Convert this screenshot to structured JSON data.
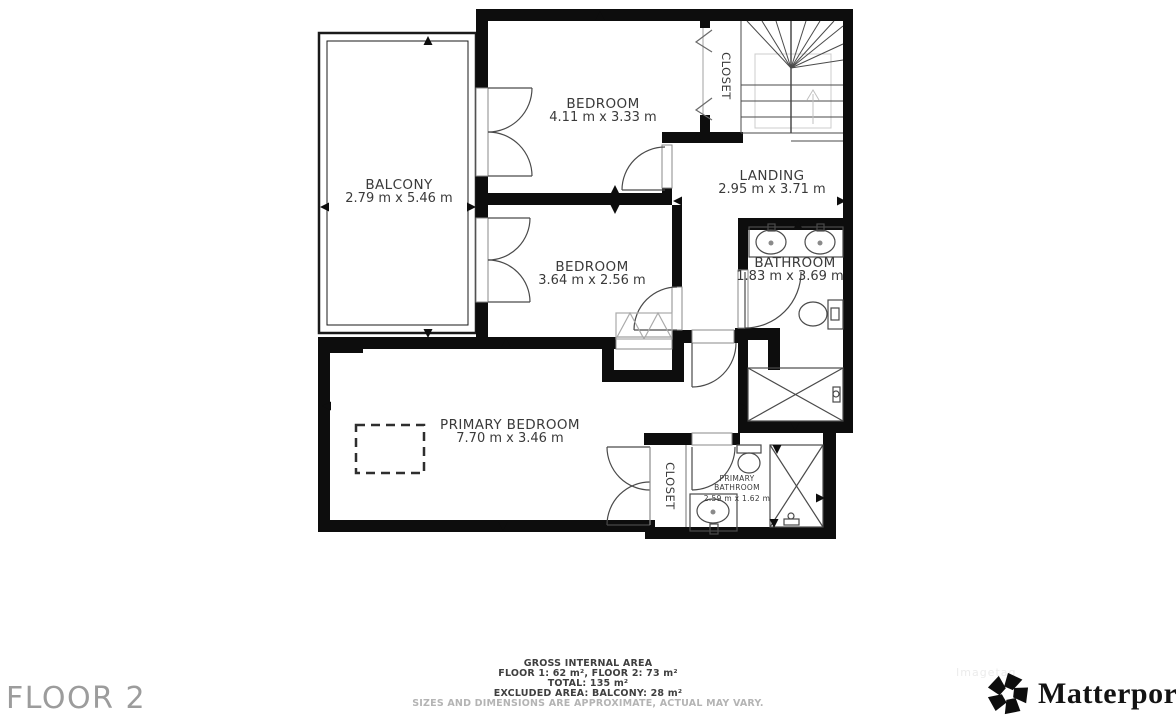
{
  "plan": {
    "rooms": {
      "balcony": {
        "name": "BALCONY",
        "dims": "2.79 m x 5.46 m"
      },
      "bedroom1": {
        "name": "BEDROOM",
        "dims": "4.11 m x 3.33 m"
      },
      "bedroom2": {
        "name": "BEDROOM",
        "dims": "3.64 m x 2.56 m"
      },
      "landing": {
        "name": "LANDING",
        "dims": "2.95 m x 3.71 m"
      },
      "bathroom": {
        "name": "BATHROOM",
        "dims": "1.83 m x 3.69 m"
      },
      "primary_bedroom": {
        "name": "PRIMARY BEDROOM",
        "dims": "7.70 m x 3.46 m"
      },
      "primary_bathroom": {
        "name_line1": "PRIMARY",
        "name_line2": "BATHROOM",
        "dims": "2.59 m x 1.62 m"
      },
      "closet_upper": {
        "name": "CLOSET"
      },
      "closet_primary": {
        "name": "CLOSET"
      }
    },
    "colors": {
      "wall": "#0d0d0d",
      "label": "#3a3a3a",
      "fixture": "#4a4a4a",
      "guide": "#cccccc"
    }
  },
  "footer": {
    "floor_label": "FLOOR 2",
    "area_summary": {
      "title": "GROSS INTERNAL AREA",
      "line1": "FLOOR 1: 62 m², FLOOR 2: 73 m²",
      "line2": "TOTAL: 135 m²",
      "line3": "EXCLUDED AREA: BALCONY: 28 m²",
      "disclaimer": "SIZES AND DIMENSIONS ARE APPROXIMATE, ACTUAL MAY VARY."
    },
    "watermark": "Imagetag",
    "brand": {
      "name": "Matterport",
      "tm": "™"
    }
  }
}
